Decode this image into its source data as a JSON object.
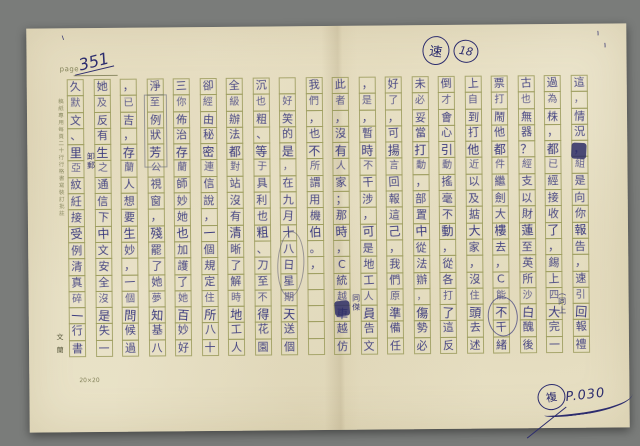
{
  "page_header": {
    "printed_label": "page",
    "page_number": "351"
  },
  "top_annotations": {
    "circled_character": "速",
    "circled_number": "18",
    "tick_mark": "ヽ"
  },
  "manuscript": {
    "rows_per_column": 17,
    "reading_order": "right-to-left",
    "columns_left_to_right": [
      "久默文、里亞紋紝接受例清真碎一行書",
      "她及反有生之通信下中文安全沒是失一",
      "，已吉，存蘭人想要生妙，一個問候過",
      "淨至例狀芳公視窗，殘罷了她夢知基八",
      "三你佈治存蘭師妙她也加護了她百妙好",
      "卻經由秘密連信說，一個規定住所八十",
      "全級辦法都對站沒有清晰了解時地工人",
      "沉也粗、等于具利也粗、刀至不得花園",
      "　好笑的是，在九月十八日星期天送個",
      "我們，也不所謂用機伯。，",
      "此者，沒有人家；那時，C統越車越仿",
      "，是，暫時不干涉，可是地工人員告文",
      "好了，可揚言回報這己，我們原準備任",
      "未必妥當打動，部置中從法辦，傷勢必",
      "倒才會心引動搖毫不動，從各打了這反",
      "上自到打他近以及掂大家，沒住頭去述",
      "票打鬧他都件繼劍大樓去，C能不干緒",
      "古也無器？經支以財蓮至英所沙白醜後",
      "過為株，都已經接收了，錫上四大完一",
      "這，情況，組是向你報告，速引回報禮"
    ]
  },
  "margin_notes": {
    "left_margin_fine_print": "稿紙專用每頁二十行行格書寫裝訂批註",
    "bottom_left_vertical": "文蘭",
    "grid_size_label": "20×20"
  },
  "corrections": {
    "interlinear_note_1": "同傑",
    "interlinear_note_2": "（同上",
    "interlinear_note_3": "卸郵"
  },
  "stamp": {
    "circled_character": "複",
    "code": "P.030"
  },
  "colors": {
    "background": "#7a7c7a",
    "paper": "#e8e1c7",
    "grid_line": "#9c9c5e",
    "ink": "#31317a",
    "pencil": "#8b8b93"
  }
}
